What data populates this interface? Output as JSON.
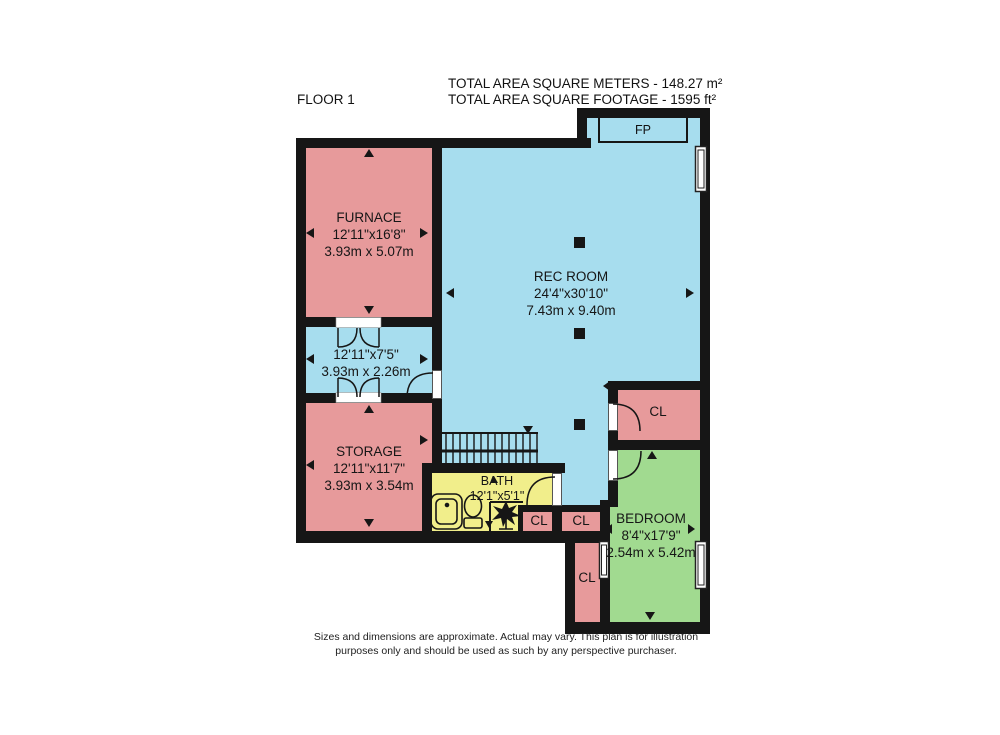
{
  "header": {
    "floor_label": "FLOOR 1",
    "total_meters": "TOTAL AREA SQUARE METERS - 148.27 m²",
    "total_footage": "TOTAL AREA SQUARE FOOTAGE - 1595 ft²"
  },
  "rooms": {
    "furnace": {
      "name": "FURNACE",
      "imperial": "12'11\"x16'8\"",
      "metric": "3.93m x 5.07m"
    },
    "hall": {
      "imperial": "12'11\"x7'5\"",
      "metric": "3.93m x 2.26m"
    },
    "storage": {
      "name": "STORAGE",
      "imperial": "12'11\"x11'7\"",
      "metric": "3.93m x 3.54m"
    },
    "rec_room": {
      "name": "REC ROOM",
      "imperial": "24'4\"x30'10\"",
      "metric": "7.43m x 9.40m"
    },
    "bath": {
      "name": "BATH",
      "imperial": "12'1\"x5'1\""
    },
    "bedroom": {
      "name": "BEDROOM",
      "imperial": "8'4\"x17'9\"",
      "metric": "2.54m x 5.42m"
    },
    "closets": {
      "closet_top": "CL",
      "closet_1": "CL",
      "closet_2": "CL",
      "closet_vertical": "CL"
    },
    "fireplace": "FP"
  },
  "footer": {
    "line1": "Sizes and dimensions are approximate. Actual may vary. This plan is for illustration",
    "line2": "purposes only and should be used as such by any perspective purchaser."
  },
  "colors": {
    "room_pink": "#e79a9b",
    "room_blue": "#a7ddee",
    "room_green": "#a1da90",
    "room_yellow": "#f1ee8b",
    "wall": "#161616"
  }
}
